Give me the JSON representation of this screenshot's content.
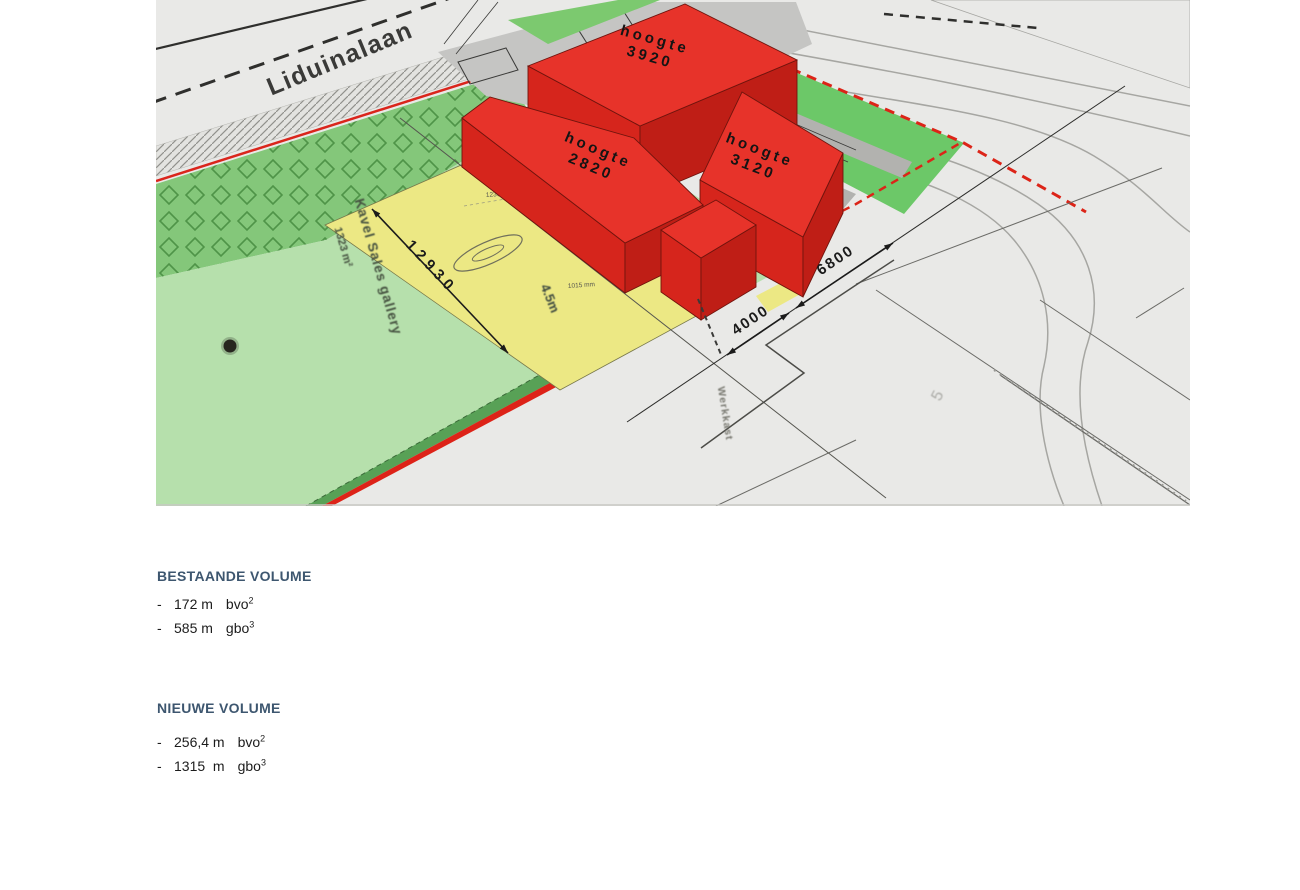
{
  "page": {
    "bg": "#ffffff"
  },
  "drawing": {
    "street_name": "Liduinalaan",
    "blocks": [
      {
        "line1": "hoogte",
        "line2": "3920"
      },
      {
        "line1": "hoogte",
        "line2": "2820"
      },
      {
        "line1": "hoogte",
        "line2": "3120"
      }
    ],
    "parcel": {
      "name": "Kavel Sales gallery",
      "area": "1323 m²",
      "length_dim": "12930",
      "height_note": "4.5m",
      "dim_top": "12390 mm",
      "dim_bottom": "1015 mm"
    },
    "dims": {
      "d1": "4000",
      "d2": "6800"
    },
    "werkkast": "Werkkast",
    "corner_mark": "5",
    "colors": {
      "building_red": "#e7332a",
      "site_green": "#b6e0ac",
      "hedge_green": "#84c77a",
      "lawn_green": "#6cc868",
      "parcel_yellow": "#ece884",
      "boundary_red": "#dc2418",
      "heading_blue": "#3d566f"
    }
  },
  "legend": {
    "existing": {
      "title": "BESTAANDE VOLUME",
      "items": [
        {
          "prefix": "-",
          "value": "172 m",
          "unit": "bvo",
          "exp": "2"
        },
        {
          "prefix": "-",
          "value": "585 m",
          "unit": "gbo",
          "exp": "3"
        }
      ]
    },
    "proposed": {
      "title": "NIEUWE VOLUME",
      "items": [
        {
          "prefix": "-",
          "value": "256,4 m",
          "unit": "bvo",
          "exp": "2"
        },
        {
          "prefix": "-",
          "value": "1315  m",
          "unit": "gbo",
          "exp": "3"
        }
      ]
    }
  }
}
